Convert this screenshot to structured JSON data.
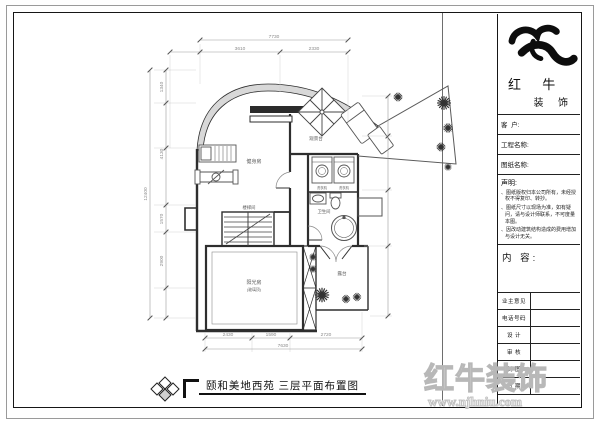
{
  "sheet": {
    "bottom_title": "颐和美地西苑 三层平面布置图",
    "watermark": {
      "brand": "红牛装饰",
      "url": "www.njhniu.com"
    }
  },
  "title_block": {
    "brand_line1": "红 牛",
    "brand_line2": "装 饰",
    "fields": [
      {
        "label": "客  户:"
      },
      {
        "label": "工程名称:"
      },
      {
        "label": "图纸名称:"
      }
    ],
    "statement": {
      "title": "声明:",
      "items": [
        "图纸版权归本公司所有，未经授权不得复印、转抄。",
        "图纸尺寸以现场为准，如有疑问，请与设计师联系，不可度量本图。",
        "因改动建筑结构造成的费用增加与设计无关。"
      ]
    },
    "content_label": "内 容:",
    "sign_rows": [
      {
        "label": "业主意见"
      },
      {
        "label": "电话号码"
      },
      {
        "label": "设 计"
      },
      {
        "label": "审 核"
      },
      {
        "label": "制 图"
      },
      {
        "label": "日 期"
      }
    ]
  },
  "plan": {
    "rooms": {
      "gym": "健身房",
      "stairs": "楼梯间",
      "bath": "卫生间",
      "washer_caption": "洗衣机",
      "terrace_top": "观景台",
      "terrace_bottom": "露台",
      "sunroom": "阳光房",
      "sunroom_note": "(玻璃顶)"
    },
    "dimensions": {
      "top": {
        "overall": "7730",
        "segments": [
          "3610",
          "2330"
        ]
      },
      "bottom": {
        "overall": "7630",
        "segments": [
          "2430",
          "1590",
          "2720"
        ]
      },
      "left": {
        "overall": "12400",
        "segments": [
          "1340",
          "4130",
          "1570",
          "2900"
        ]
      }
    }
  }
}
